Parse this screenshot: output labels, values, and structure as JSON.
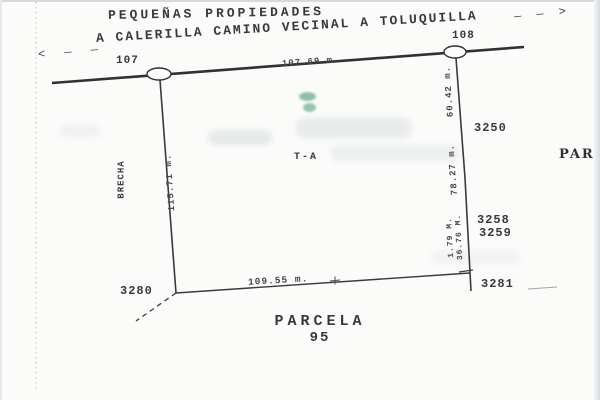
{
  "header": {
    "area_label": "PEQUEÑAS PROPIEDADES",
    "road_label": "A CALERILLA CAMINO VECINAL A TOLUQUILLA",
    "arrow_left": "< — —",
    "arrow_right": "— — >"
  },
  "survey_points": {
    "p107": "107",
    "p108": "108",
    "p3250": "3250",
    "p3258": "3258",
    "p3259": "3259",
    "p3280": "3280",
    "p3281": "3281"
  },
  "measurements": {
    "north": "107.69 m.",
    "south": "109.55 m.",
    "west": "115.71 m.",
    "east_upper": "60.42 m.",
    "east_middle": "78.27 m.",
    "east_lower_a": "1.79 M.",
    "east_lower_b": "36.76 M."
  },
  "labels": {
    "west_path": "BRECHA",
    "interior": "T-A",
    "parcel_word": "PARCELA",
    "parcel_number": "95",
    "east_partial": "PAR"
  },
  "colors": {
    "ink": "#39393c",
    "paper": "#fbfbfa",
    "scan_edge": "#cdd2d5",
    "ghost_gray": "#d6dddd",
    "ghost_green": "#55a07c"
  }
}
